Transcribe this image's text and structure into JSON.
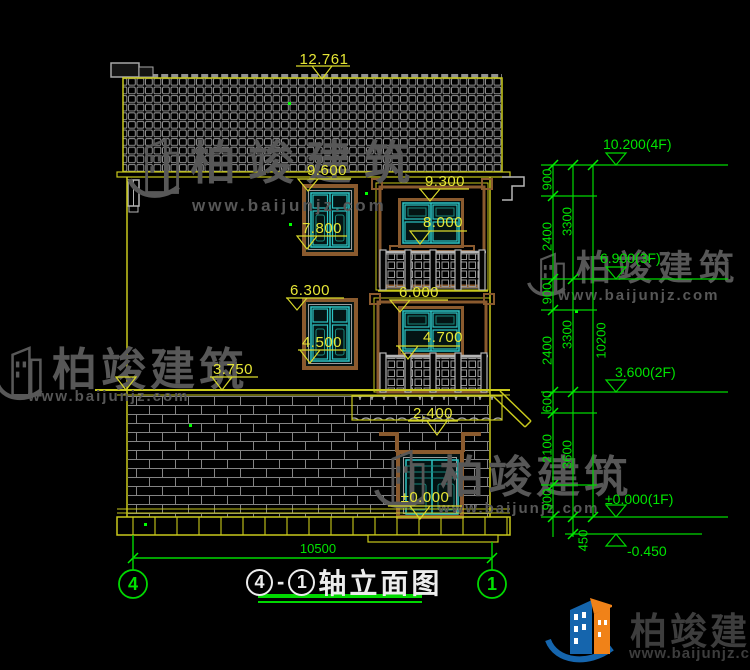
{
  "colors": {
    "background": "#000000",
    "cad_yellow": "#d9d92a",
    "cad_green": "#00d800",
    "cad_cyan": "#2cc4c4",
    "cad_brown": "#8a5a2e",
    "hatch_gray": "#8f8f8f",
    "watermark_gray": "#575757",
    "title_white": "#ececec",
    "logo_blue": "#1565ad",
    "logo_orange": "#f08218"
  },
  "watermark": {
    "brand": "柏竣建筑",
    "site": "www.baijunjz.com"
  },
  "footer_logo": {
    "brand": "柏竣建筑",
    "site": "www.baijunjz.com"
  },
  "title": {
    "axis_left": "4",
    "dash": "-",
    "axis_right": "1",
    "name": "轴立面图"
  },
  "elevation_markers": {
    "ridge": "12.761",
    "win3f_head": "9.600",
    "win3f_sill": "7.800",
    "bay3f_head": "9.300",
    "bay3f_sill": "8.000",
    "win2f_head": "6.300",
    "win2f_sill": "4.500",
    "bay2f_head": "6.000",
    "bay2f_sill": "4.700",
    "floor2": "3.750",
    "canopy_eave": "2.400",
    "entry": "±0.000"
  },
  "levels": [
    {
      "label": "10.200(4F)"
    },
    {
      "label": "6.900(3F)"
    },
    {
      "label": "3.600(2F)"
    },
    {
      "label": "±0.000(1F)"
    },
    {
      "label": "-0.450"
    }
  ],
  "chain": {
    "col1": [
      "900",
      "2400",
      "900",
      "2400",
      "600",
      "2100",
      "900"
    ],
    "col2": [
      "3300",
      "3300",
      "3600"
    ],
    "basement": "450",
    "total": "10200"
  },
  "width_dim": "10500",
  "axes": {
    "left": "4",
    "right": "1"
  }
}
